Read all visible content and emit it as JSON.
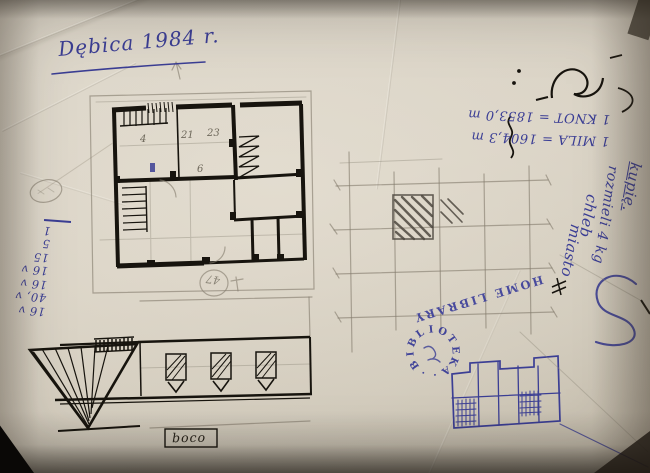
{
  "photo": {
    "paper_color": "#d7d0c2",
    "ink_blue": "#3b3e94",
    "ink_black": "#17140e",
    "pencil_gray": "#847d6e"
  },
  "annotations": {
    "date_note": "Dębica 1984 r.",
    "conversions": {
      "line1": "1 MILA = 1604,3 m",
      "line2": "1 KNOT = 1853,0 m"
    },
    "shopping_list": {
      "item1": "kupię.",
      "item2": "rozmieli 4 kg",
      "item3": "chleb",
      "item4": "miasto"
    },
    "stamp": {
      "home_library": "HOME LIBRARY",
      "ring_text": "·BIBLIOTEKA·"
    },
    "margin_column": {
      "rows": [
        "16 v",
        "40, v",
        "16 v",
        "16 v",
        "15",
        "5",
        "1"
      ]
    },
    "plan_room_numbers": {
      "n1": "4",
      "n2": "21",
      "n3": "23",
      "n4": "6"
    },
    "circled_number": "47",
    "bottom_label": "boco"
  }
}
